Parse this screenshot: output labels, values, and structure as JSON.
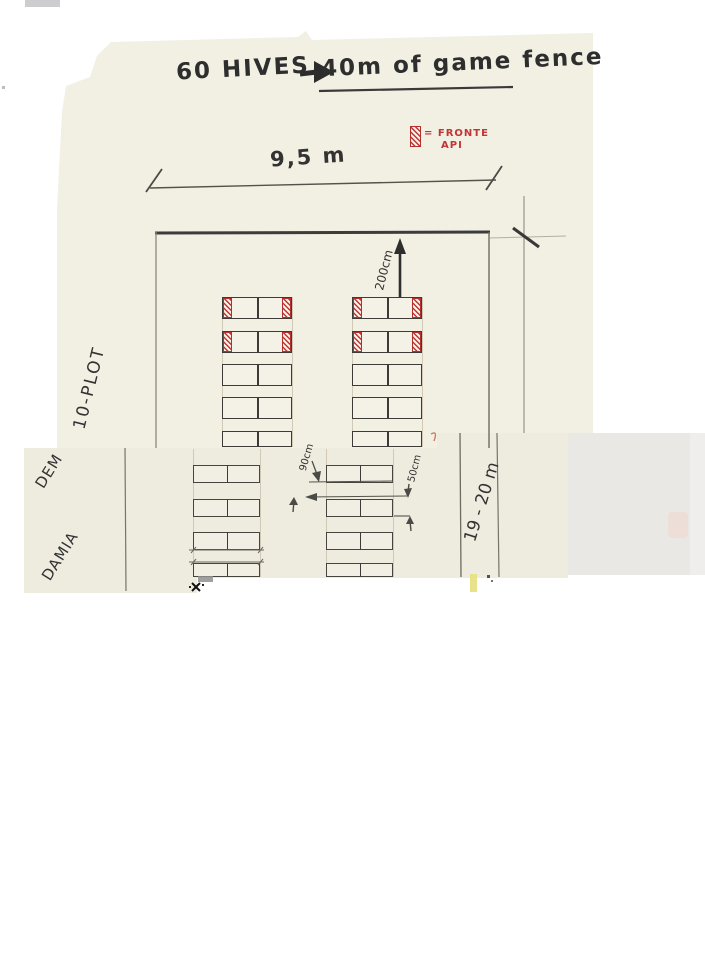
{
  "document": {
    "title": {
      "left": "60 HIVES",
      "right": "40m of game fence"
    },
    "legend": {
      "line1": "= FRONTE",
      "line2": "API"
    },
    "labels": {
      "width": "9,5 m",
      "fence_gap": "200cm",
      "aisle": "90cm",
      "row_gap": "50cm",
      "plot_length": "19 - 20 m",
      "margin_top": "10-PLOT",
      "margin_mid_1": "DEM",
      "margin_mid_2": "DAMIA"
    },
    "colors": {
      "paper": "#f2efe3",
      "paper_band": "#eeebdf",
      "scan_gray": "#e9e8e5",
      "ink": "#3a3a3a",
      "red": "#c23535"
    },
    "diagram": {
      "bands": [
        {
          "name": "top",
          "cols": [
            222,
            352
          ],
          "rowYs": [
            297,
            331,
            364,
            397,
            431
          ],
          "rowHs": [
            22,
            22,
            22,
            22,
            16
          ],
          "rowW": 70,
          "redRows": [
            0,
            1
          ],
          "guideTop": 297,
          "guideBottom": 447
        },
        {
          "name": "middle",
          "cols": [
            193,
            326
          ],
          "rowYs": [
            465,
            499,
            532,
            563
          ],
          "rowHs": [
            18,
            18,
            18,
            14
          ],
          "rowW": 67,
          "redRows": [],
          "guideTop": 449,
          "guideBottom": 577
        }
      ]
    }
  }
}
